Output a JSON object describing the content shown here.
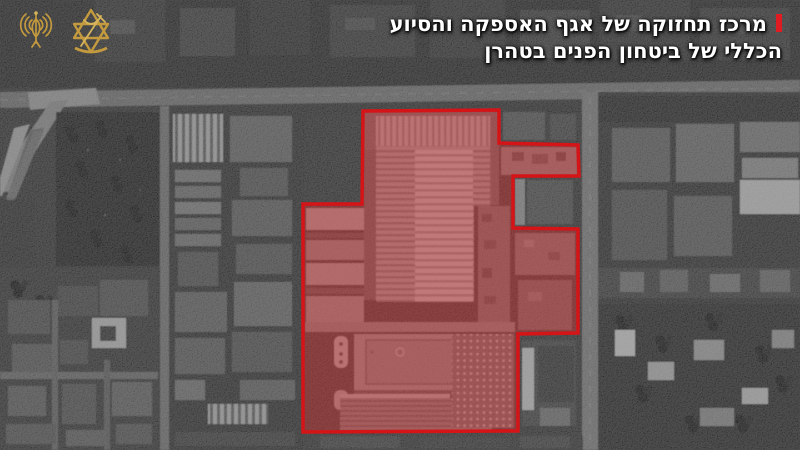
{
  "header": {
    "caption_line1": "מרכז תחזוקה של אגף האספקה והסיוע",
    "caption_line2": "הכללי של ביטחון הפנים בטהרן",
    "marker_color": "#e11b22",
    "text_color": "#ffffff"
  },
  "logos": {
    "spokesperson_icon": "idf-spokesperson-emblem",
    "idf_icon": "idf-emblem",
    "gold_color": "#c49a3f"
  },
  "map": {
    "kind": "grayscale-satellite",
    "highlight": {
      "points": "363,111 499,110 499,143 578,145 579,176 513,176 513,228 578,229 578,333 518,334 518,431 303,432 303,204 362,204",
      "stroke_color": "#d51418",
      "fill_color": "#d62a2a",
      "fill_opacity": "0.42"
    }
  }
}
